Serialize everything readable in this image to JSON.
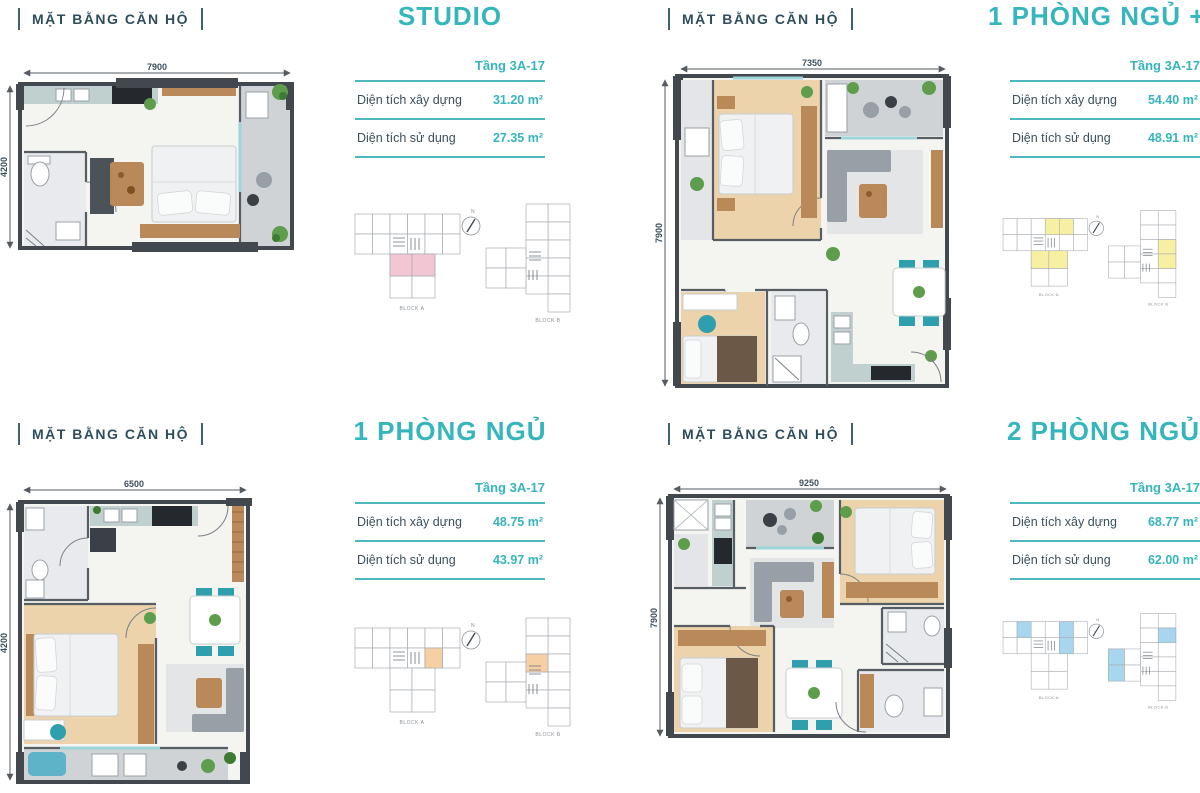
{
  "shared": {
    "section_label": "MẶT BẰNG CĂN HỘ",
    "floor_label": "Tầng 3A-17",
    "built_label": "Diện tích xây dựng",
    "usable_label": "Diện tích sử dụng",
    "block_a": "BLOCK A",
    "block_b": "BLOCK B",
    "north": "N",
    "accent": "#35b5bc",
    "heading_color": "#2f4e5d"
  },
  "units": [
    {
      "name": "studio",
      "title": "STUDIO",
      "built_area": "31.20 m²",
      "usable_area": "27.35 m²",
      "dim_w": "7900",
      "dim_h": "4200",
      "highlight": "#f2c6d3"
    },
    {
      "name": "1-phong-ngu-plus",
      "title": "1 PHÒNG NGỦ +",
      "built_area": "54.40 m²",
      "usable_area": "48.91 m²",
      "dim_w": "7350",
      "dim_h": "7900",
      "highlight": "#f7f0a2"
    },
    {
      "name": "1-phong-ngu",
      "title": "1 PHÒNG NGỦ",
      "built_area": "48.75 m²",
      "usable_area": "43.97 m²",
      "dim_w": "6500",
      "dim_h": "4200",
      "highlight": "#f6d0a4"
    },
    {
      "name": "2-phong-ngu",
      "title": "2 PHÒNG NGỦ",
      "built_area": "68.77 m²",
      "usable_area": "62.00 m²",
      "dim_w": "9250",
      "dim_h": "7900",
      "highlight": "#a9d6ef"
    }
  ]
}
